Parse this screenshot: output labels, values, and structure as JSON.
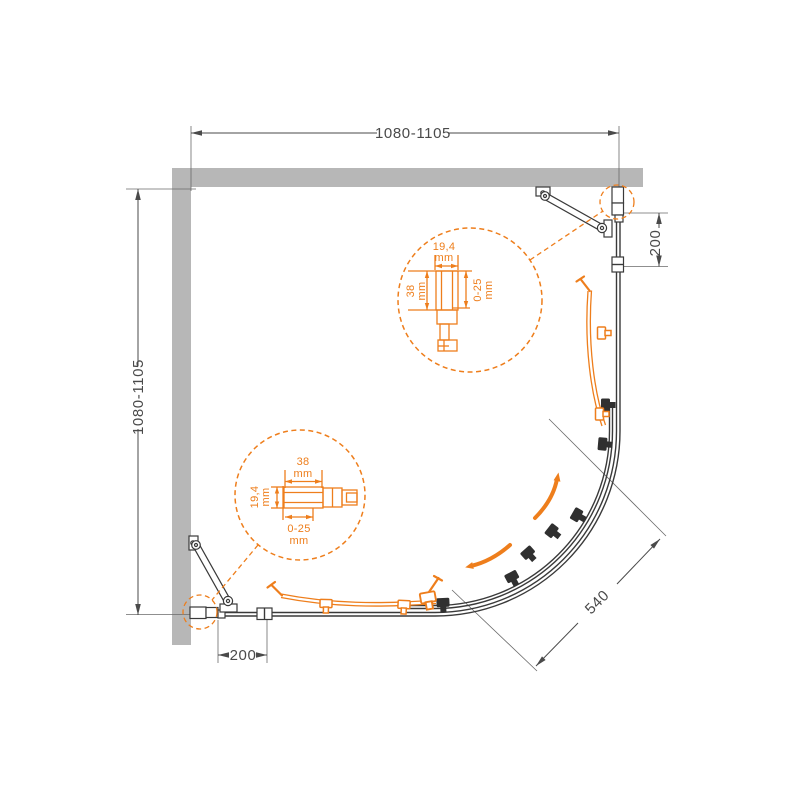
{
  "drawing": {
    "dimensions": {
      "top_width": "1080-1105",
      "left_height": "1080-1105",
      "right_wall_offset": "200",
      "bottom_wall_offset": "200",
      "diagonal_entry": "540"
    },
    "detail_top": {
      "width": "19,4",
      "width_unit": "mm",
      "height": "38",
      "height_unit": "mm",
      "range": "0-25",
      "range_unit": "mm"
    },
    "detail_bottom": {
      "width": "38",
      "width_unit": "mm",
      "height": "19,4",
      "height_unit": "mm",
      "range": "0-25",
      "range_unit": "mm"
    },
    "colors": {
      "accent_orange": "#ee7e1c",
      "wall_gray": "#b7b7b7",
      "line_dark": "#3a3a3a",
      "dim_text": "#4a4a4a"
    }
  }
}
